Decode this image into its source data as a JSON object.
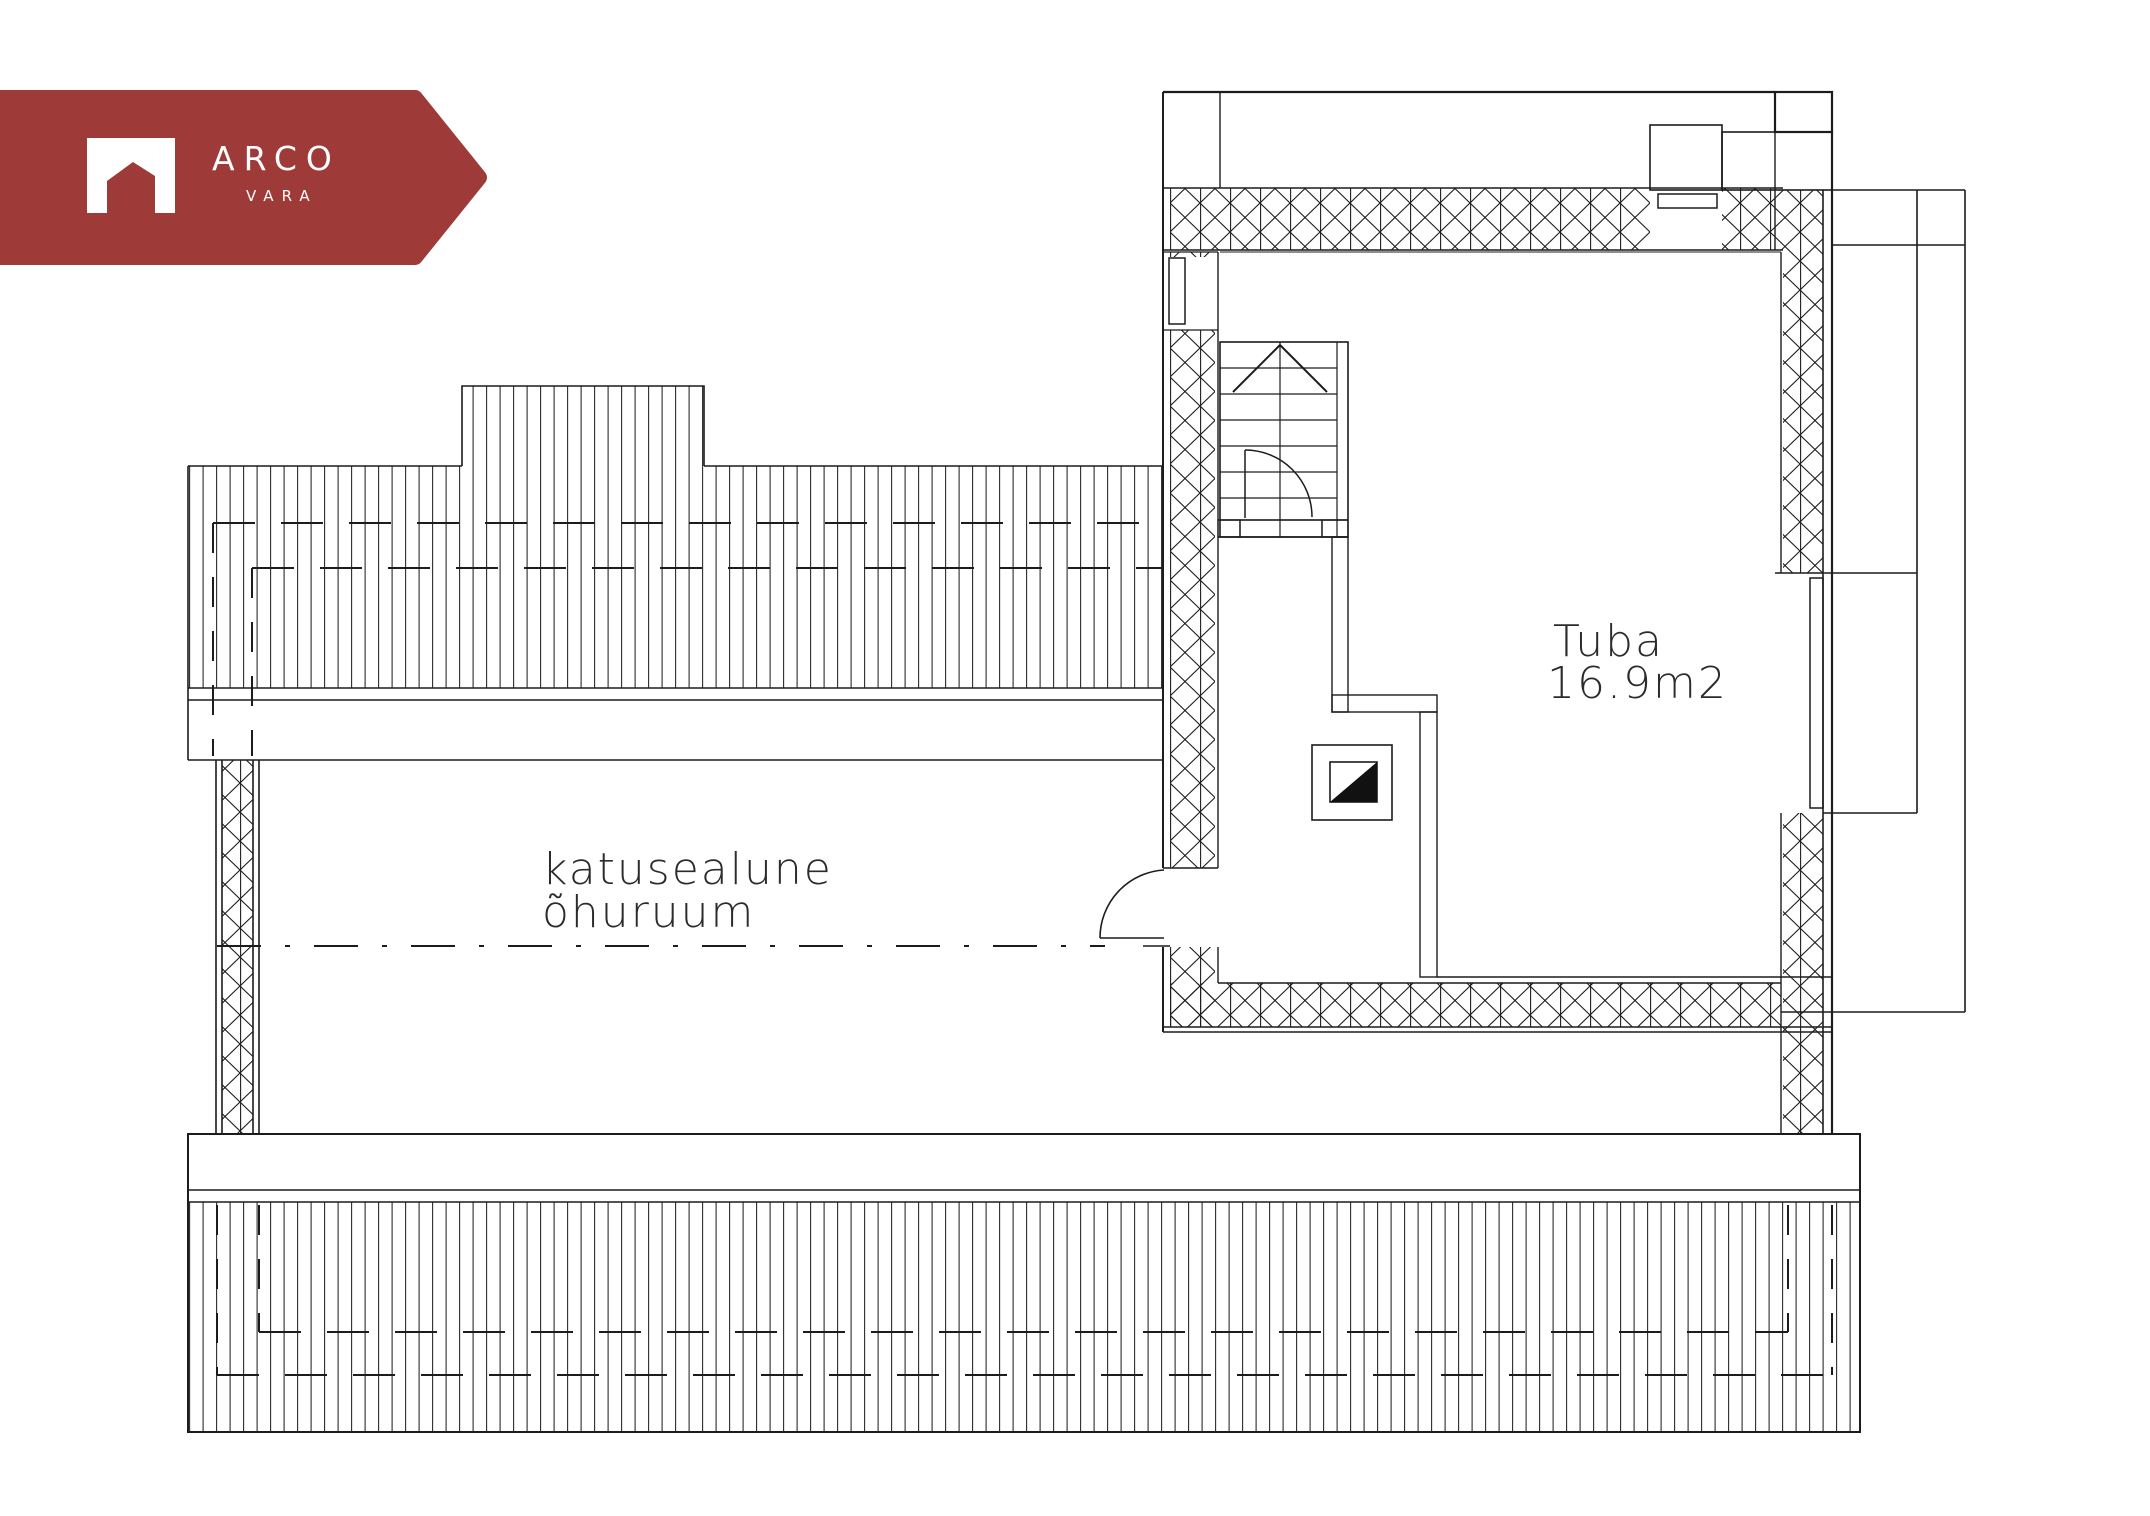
{
  "page": {
    "background": "#ffffff",
    "type": "real-estate floor plan"
  },
  "watermark": {
    "brand": "ARCO",
    "subbrand": "VARA",
    "badge_color": "#9E3A38",
    "text_color": "#FFFFFF",
    "icon": "house-icon"
  },
  "floor_plan": {
    "line_color": "#1C1C1C",
    "room": {
      "label": "Tuba",
      "area": "16.9m2"
    },
    "attic_label": {
      "line1": "katusealune",
      "line2": "õhuruum"
    }
  }
}
